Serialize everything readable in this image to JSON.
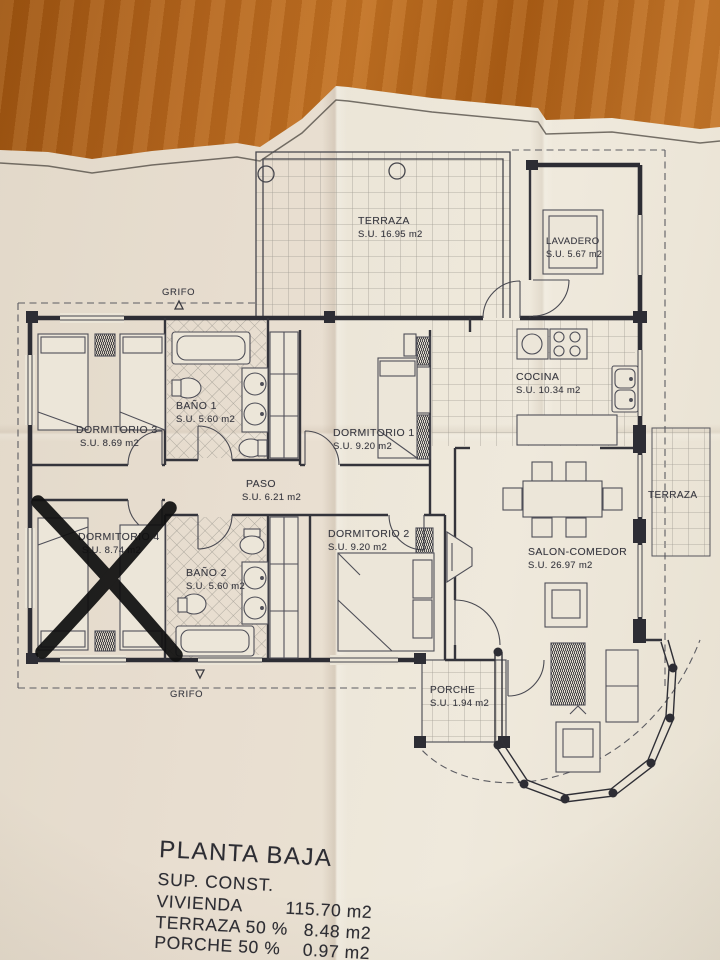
{
  "scene": {
    "description": "photo of an architectural ground-floor plan on paper lying on a wooden table",
    "wood_color": "#b2641c",
    "paper_color": "#ebe5d7",
    "ink_color": "#2d2d34",
    "marker_color": "#101010"
  },
  "plan": {
    "rooms": [
      {
        "name": "TERRAZA",
        "area": "S.U. 16.95 m2"
      },
      {
        "name": "LAVADERO",
        "area": "S.U. 5.67 m2"
      },
      {
        "name": "COCINA",
        "area": "S.U. 10.34 m2"
      },
      {
        "name": "DORMITORIO 3",
        "area": "S.U. 8.69 m2"
      },
      {
        "name": "BAÑO 1",
        "area": "S.U. 5.60 m2"
      },
      {
        "name": "DORMITORIO 1",
        "area": "S.U. 9.20 m2"
      },
      {
        "name": "PASO",
        "area": "S.U. 6.21 m2"
      },
      {
        "name": "DORMITORIO 4",
        "area": "S.U. 8.74 m2"
      },
      {
        "name": "BAÑO 2",
        "area": "S.U. 5.60 m2"
      },
      {
        "name": "DORMITORIO 2",
        "area": "S.U. 9.20 m2"
      },
      {
        "name": "SALON-COMEDOR",
        "area": "S.U. 26.97 m2"
      },
      {
        "name": "PORCHE",
        "area": "S.U. 1.94 m2"
      },
      {
        "name": "TERRAZA",
        "area": ""
      }
    ],
    "markers": {
      "grifo_top": "GRIFO",
      "grifo_bottom": "GRIFO"
    },
    "annotation": "hand-drawn black X crossing out DORMITORIO 4"
  },
  "summary": {
    "title": "PLANTA BAJA",
    "subtitle": "SUP. CONST.",
    "rows": [
      {
        "label": "VIVIENDA",
        "value": "115.70 m2"
      },
      {
        "label": "TERRAZA 50 %",
        "value": "8.48 m2"
      },
      {
        "label": "PORCHE 50 %",
        "value": "0.97 m2"
      }
    ]
  }
}
